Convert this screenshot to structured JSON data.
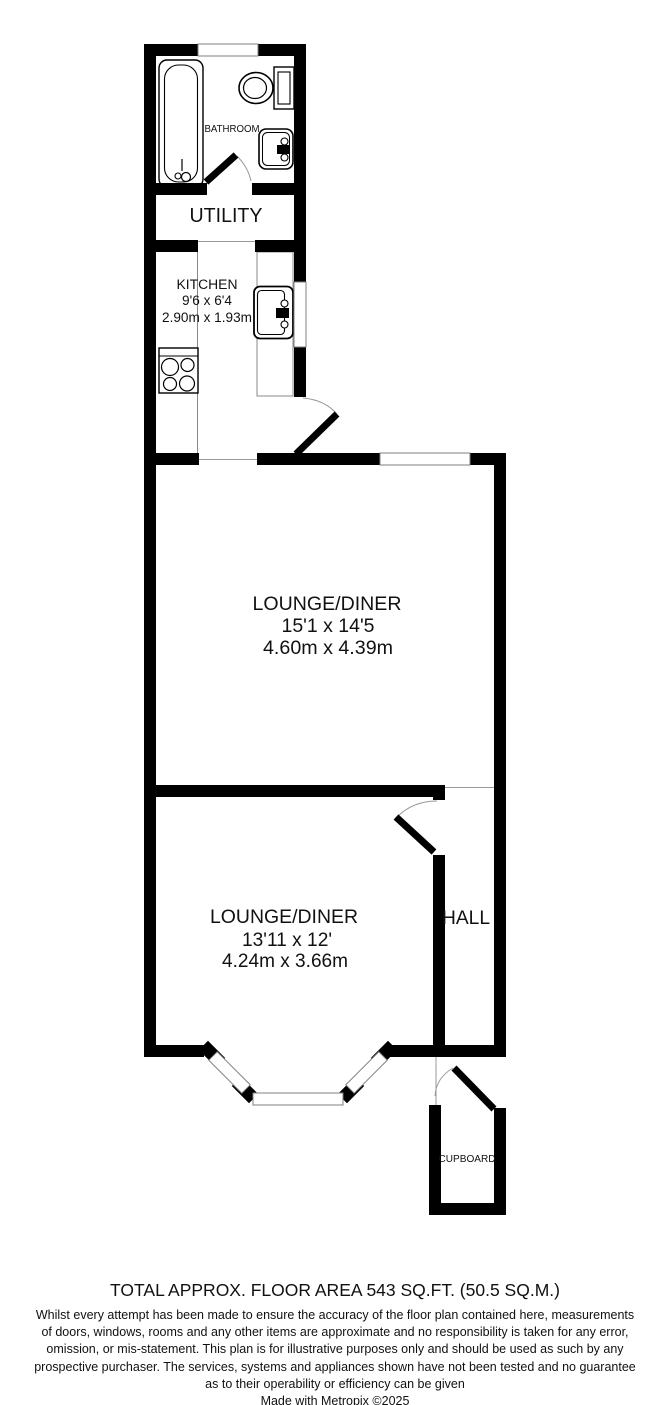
{
  "plan": {
    "rooms": {
      "bathroom": {
        "label": "BATHROOM"
      },
      "utility": {
        "label": "UTILITY"
      },
      "kitchen": {
        "label": "KITCHEN",
        "imperial": "9'6 x 6'4",
        "metric": "2.90m x 1.93m"
      },
      "lounge_diner_1": {
        "label": "LOUNGE/DINER",
        "imperial": "15'1 x 14'5",
        "metric": "4.60m x 4.39m"
      },
      "lounge_diner_2": {
        "label": "LOUNGE/DINER",
        "imperial": "13'11 x 12'",
        "metric": "4.24m x 3.66m"
      },
      "hall": {
        "label": "HALL"
      },
      "cupboard": {
        "label": "CUPBOARD"
      }
    },
    "fixtures": [
      "bathtub",
      "toilet",
      "basin",
      "kitchen-sink",
      "hob",
      "counters"
    ],
    "colors": {
      "wall": "#000000",
      "background": "#ffffff",
      "outline": "#808080"
    }
  },
  "footer": {
    "total_area": "TOTAL APPROX. FLOOR AREA 543 SQ.FT. (50.5 SQ.M.)",
    "disclaimer_lines": [
      "Whilst every attempt has been made to ensure the accuracy of the floor plan contained here, measurements",
      "of doors, windows, rooms and any other items are approximate and no responsibility is taken for any error,",
      "omission, or mis-statement. This plan is for illustrative purposes only and should be used as such by any",
      "prospective purchaser. The services, systems and appliances shown have not been tested and no guarantee",
      "as to their operability or efficiency can be given"
    ],
    "credit": "Made with Metropix ©2025"
  }
}
